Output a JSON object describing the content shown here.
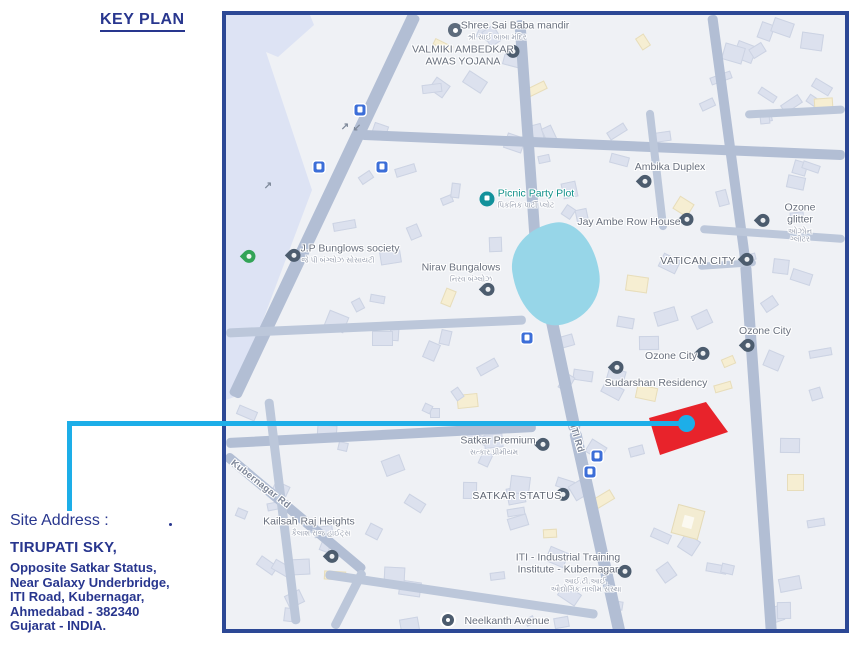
{
  "page": {
    "title": "KEY PLAN"
  },
  "site_address": {
    "heading": "Site Address :",
    "name": "TIRUPATI SKY,",
    "lines": [
      "Opposite Satkar Status,",
      "Near Galaxy Underbridge,",
      "ITI Road, Kubernagar,",
      "Ahmedabad - 382340",
      "Gujarat - INDIA."
    ]
  },
  "colors": {
    "navy_text": "#28368e",
    "map_border": "#2c4895",
    "leader_cyan": "#1daee8",
    "site_red": "#e8232b",
    "poi_teal": "#12918a"
  },
  "map": {
    "labels": [
      {
        "text": "Shree Sai Baba mandir",
        "sub": "શ્રી સાઈ બાબા મંદિર",
        "x": 289,
        "y": 16,
        "subdx": -18
      },
      {
        "text": "VALMIKI AMBEDKAR\nAWAS YOJANA",
        "x": 237,
        "y": 41
      },
      {
        "text": "Ambika Duplex",
        "x": 444,
        "y": 153
      },
      {
        "text": "Picnic Party Plot",
        "sub": "પિકનિક પાર્ટી પ્લોટ",
        "x": 310,
        "y": 184,
        "cls": "teal",
        "subdx": -10
      },
      {
        "text": "Jay Ambe Row House",
        "x": 403,
        "y": 208
      },
      {
        "text": "Ozone glitter",
        "sub": "ઓઝોન ગ્લીટર",
        "x": 574,
        "y": 208
      },
      {
        "text": "J.P Bunglows society",
        "sub": "જે પી બંગ્લોઝ સોસાયટી",
        "x": 124,
        "y": 239,
        "subdx": -12
      },
      {
        "text": "Nirav Bungalows",
        "sub": "નિરવ બંગ્લોઝ",
        "x": 235,
        "y": 258,
        "subdx": 10
      },
      {
        "text": "VATICAN CITY",
        "x": 472,
        "y": 247,
        "cls": "caps"
      },
      {
        "text": "Ozone City",
        "x": 539,
        "y": 317
      },
      {
        "text": "Ozone City",
        "x": 445,
        "y": 342
      },
      {
        "text": "Sudarshan Residency",
        "x": 430,
        "y": 369
      },
      {
        "text": "Satkar Premium",
        "sub": "સત્કાર પ્રીમીયમ",
        "x": 272,
        "y": 431,
        "subdx": -4
      },
      {
        "text": "SATKAR STATUS",
        "x": 291,
        "y": 482,
        "cls": "caps"
      },
      {
        "text": "ITI Rd",
        "x": 350,
        "y": 424,
        "rot": 73,
        "cls": "road"
      },
      {
        "text": "Kubernagar Rd",
        "x": 34,
        "y": 470,
        "rot": 38,
        "cls": "road"
      },
      {
        "text": "Kailsah Raj Heights",
        "sub": "કૈલાશ રાજ હાઈટ્સ",
        "x": 83,
        "y": 512,
        "subdx": 12
      },
      {
        "text": "ITI - Industrial Training\nInstitute - Kubernagar",
        "sub": "આઈ.ટી.આઈ.\nઔદ્યોગિક તાલીમ સંસ્થા",
        "x": 342,
        "y": 558,
        "subdx": 18
      },
      {
        "text": "Neelkanth Avenue",
        "x": 281,
        "y": 607
      }
    ],
    "markers": [
      {
        "kind": "pin",
        "name": "map-pin-icon",
        "x": 287,
        "y": 40
      },
      {
        "kind": "pin",
        "name": "map-pin-icon",
        "x": 419,
        "y": 170
      },
      {
        "kind": "pin",
        "name": "map-pin-icon",
        "x": 461,
        "y": 208
      },
      {
        "kind": "pin",
        "name": "map-pin-icon",
        "x": 537,
        "y": 209
      },
      {
        "kind": "pin",
        "name": "map-pin-icon",
        "x": 68,
        "y": 244
      },
      {
        "kind": "pin",
        "name": "map-pin-icon",
        "x": 262,
        "y": 278
      },
      {
        "kind": "pin",
        "name": "map-pin-icon",
        "x": 521,
        "y": 248
      },
      {
        "kind": "pin",
        "name": "map-pin-icon",
        "x": 522,
        "y": 334
      },
      {
        "kind": "pin",
        "name": "map-pin-icon",
        "x": 477,
        "y": 342
      },
      {
        "kind": "pin",
        "name": "map-pin-icon",
        "x": 391,
        "y": 356
      },
      {
        "kind": "pin",
        "name": "map-pin-icon",
        "x": 317,
        "y": 433
      },
      {
        "kind": "pin",
        "name": "map-pin-icon",
        "x": 337,
        "y": 483
      },
      {
        "kind": "pin",
        "name": "map-pin-icon",
        "x": 106,
        "y": 545
      },
      {
        "kind": "pin",
        "name": "map-pin-icon",
        "x": 399,
        "y": 560
      },
      {
        "kind": "pin-green",
        "name": "green-pin-icon",
        "x": 23,
        "y": 245
      },
      {
        "kind": "icon-om",
        "name": "temple-icon",
        "x": 229,
        "y": 15
      },
      {
        "kind": "icon-picnic",
        "name": "picnic-icon",
        "x": 261,
        "y": 184
      },
      {
        "kind": "icon-transit",
        "name": "bus-stop-icon",
        "x": 134,
        "y": 95
      },
      {
        "kind": "icon-transit",
        "name": "bus-stop-icon",
        "x": 93,
        "y": 152
      },
      {
        "kind": "icon-transit",
        "name": "bus-stop-icon",
        "x": 156,
        "y": 152
      },
      {
        "kind": "icon-transit",
        "name": "bus-stop-icon",
        "x": 301,
        "y": 323
      },
      {
        "kind": "icon-transit",
        "name": "bus-stop-icon",
        "x": 371,
        "y": 441
      },
      {
        "kind": "icon-transit",
        "name": "bus-stop-icon",
        "x": 364,
        "y": 457
      },
      {
        "kind": "icon-circle",
        "name": "poi-circle-icon",
        "x": 222,
        "y": 605
      },
      {
        "kind": "arrow",
        "name": "oneway-arrow-icon",
        "glyph": "↗",
        "x": 119,
        "y": 112
      },
      {
        "kind": "arrow",
        "name": "oneway-arrow-icon",
        "glyph": "↙",
        "x": 131,
        "y": 113
      },
      {
        "kind": "arrow",
        "name": "oneway-arrow-icon",
        "glyph": "↗",
        "x": 42,
        "y": 171
      }
    ],
    "site_marker": {
      "label": "site-location-tirupati-sky",
      "points": [
        [
          3,
          18
        ],
        [
          60,
          2
        ],
        [
          82,
          32
        ],
        [
          14,
          55
        ]
      ]
    }
  }
}
